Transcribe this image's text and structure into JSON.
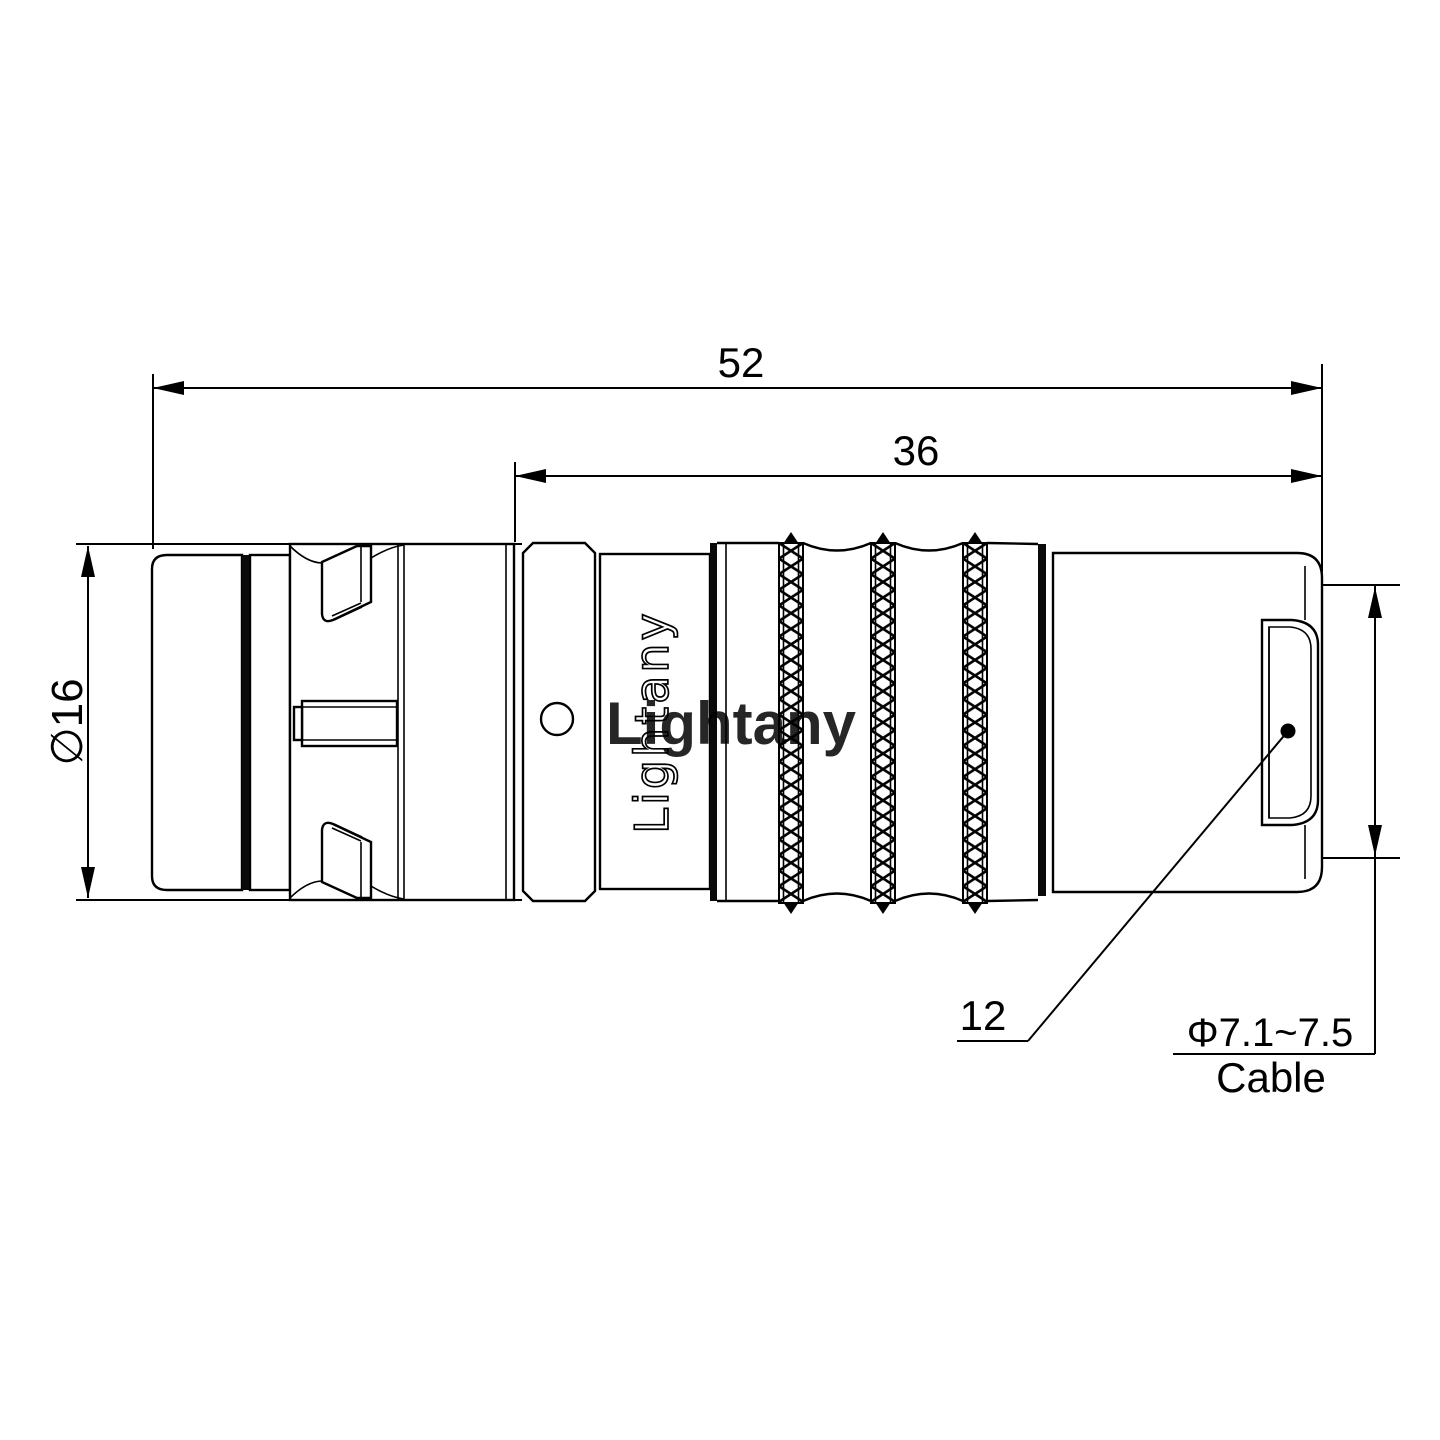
{
  "drawing": {
    "dimensions": {
      "total_length": "52",
      "body_length": "36",
      "shell_diameter": "∅16",
      "rear_diameter": "12",
      "cable_range": "Φ7.1~7.5",
      "cable_word": "Cable"
    },
    "branding": {
      "body_engraving": "Lightany",
      "watermark": "Lightany"
    },
    "colors": {
      "line": "#000000",
      "watermark_pink": "#f2b2b5"
    }
  }
}
